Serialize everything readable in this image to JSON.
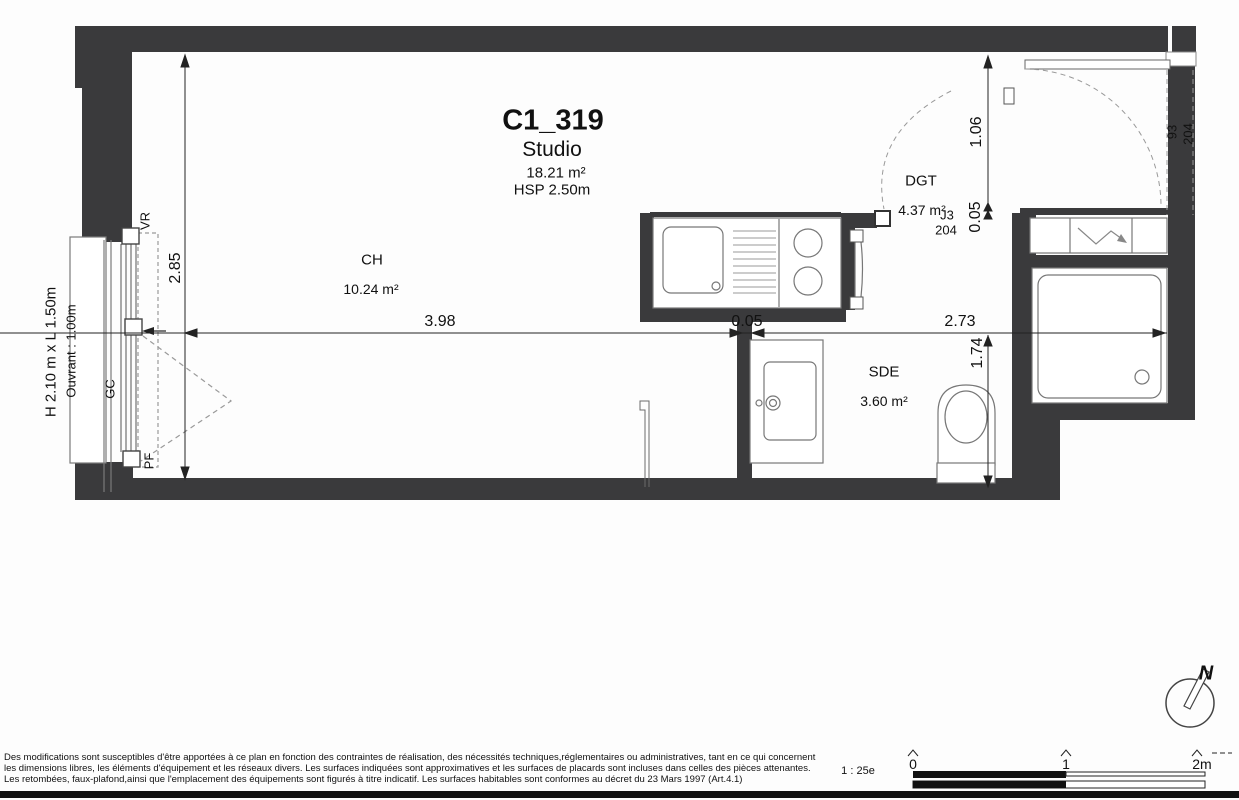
{
  "plan": {
    "title": {
      "unit_id": "C1_319",
      "unit_type": "Studio",
      "total_area": "18.21 m²",
      "ceiling_height": "HSP 2.50m"
    },
    "rooms": [
      {
        "code": "CH",
        "area": "10.24 m²"
      },
      {
        "code": "DGT",
        "area": "4.37 m²"
      },
      {
        "code": "SDE",
        "area": "3.60 m²"
      }
    ],
    "dimensions": {
      "room_width": "3.98",
      "partition": "0.05",
      "right_width": "2.73",
      "room_depth": "2.85",
      "entry_depth": "1.06",
      "entry_partition": "0.05",
      "sde_depth": "1.74"
    },
    "joinery": {
      "entry_door_width": "93",
      "entry_door_height": "204",
      "j3_code": "J3",
      "j3_height": "204",
      "window_size": "H 2.10 m x L 1.50m",
      "window_opening": "Ouvrant : 1.00m",
      "vr": "VR",
      "gc": "GC",
      "pf": "PF"
    }
  },
  "scale_bar": {
    "ratio": "1 : 25e",
    "tick_0": "0",
    "tick_1": "1",
    "tick_2": "2m"
  },
  "compass": {
    "north": "N"
  },
  "footer": {
    "line1": "Des modifications sont susceptibles d'être apportées à ce plan en fonction des contraintes de réalisation, des nécessités techniques,réglementaires ou administratives, tant en ce qui concernent",
    "line2": "les dimensions libres, les éléments d'équipement et les réseaux divers. Les surfaces indiquées sont approximatives et les surfaces de placards sont incluses dans celles des pièces attenantes.",
    "line3": "Les retombées, faux-plafond,ainsi que l'emplacement des équipements sont figurés à titre indicatif. Les surfaces habitables sont conformes au décret du 23 Mars 1997 (Art.4.1)"
  },
  "colors": {
    "wall": "#3a3a3c",
    "line": "#222222",
    "light_line": "#777777"
  }
}
